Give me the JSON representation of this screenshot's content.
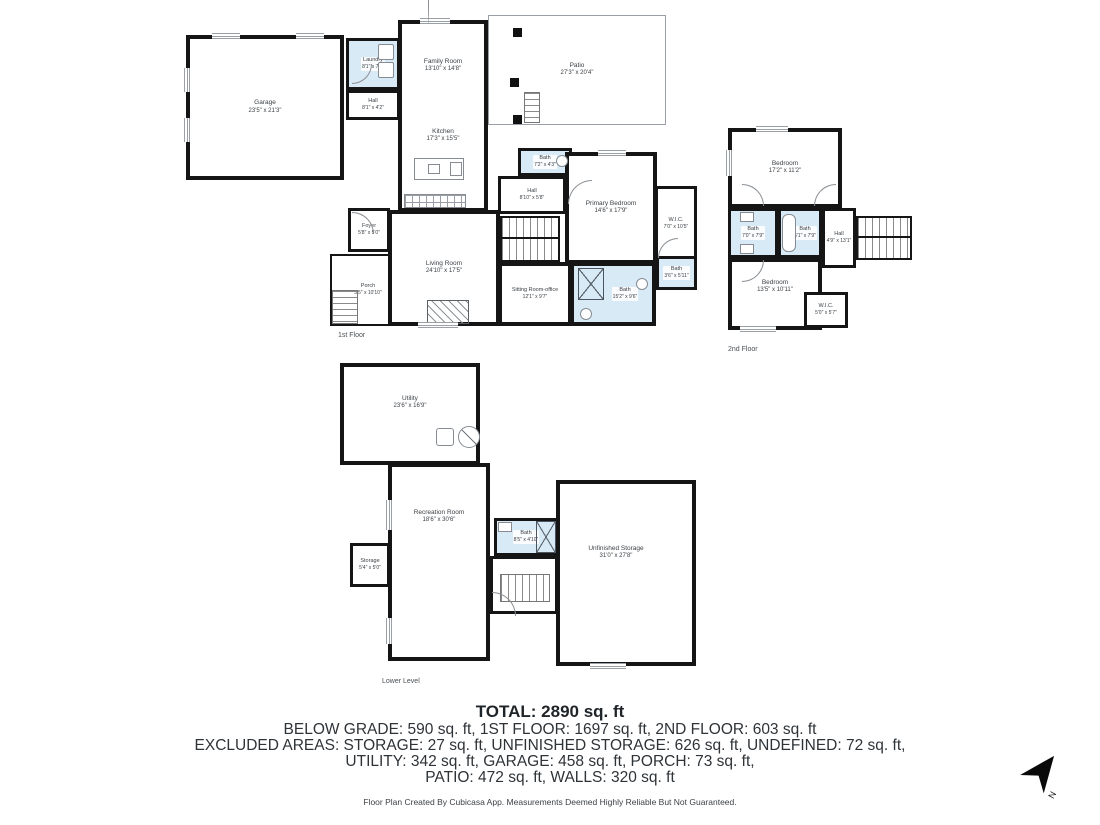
{
  "title": "Residential floor plan",
  "floors": {
    "first": {
      "label": "1st Floor",
      "rooms": {
        "garage": {
          "name": "Garage",
          "dims": "23'5\" x 21'3\""
        },
        "laundry": {
          "name": "Laundry",
          "dims": "8'1\" x 7'6\""
        },
        "hall_a": {
          "name": "Hall",
          "dims": "8'1\" x 4'2\""
        },
        "family": {
          "name": "Family Room",
          "dims": "13'10\" x 14'8\""
        },
        "kitchen": {
          "name": "Kitchen",
          "dims": "17'3\" x 15'5\""
        },
        "patio": {
          "name": "Patio",
          "dims": "27'3\" x 20'4\""
        },
        "bath_a": {
          "name": "Bath",
          "dims": "7'2\" x 4'3\""
        },
        "hall_b": {
          "name": "Hall",
          "dims": "8'10\" x 5'8\""
        },
        "primary_bedroom": {
          "name": "Primary Bedroom",
          "dims": "14'6\" x 17'9\""
        },
        "wic": {
          "name": "W.I.C.",
          "dims": "7'0\" x 10'5\""
        },
        "bath_b": {
          "name": "Bath",
          "dims": "3'6\" x 5'11\""
        },
        "bath_c": {
          "name": "Bath",
          "dims": "15'2\" x 9'6\""
        },
        "sitting": {
          "name": "Sitting Room-office",
          "dims": "12'1\" x 9'7\""
        },
        "living": {
          "name": "Living Room",
          "dims": "24'10\" x 17'5\""
        },
        "foyer": {
          "name": "Foyer",
          "dims": "5'8\" x 5'0\""
        },
        "porch": {
          "name": "Porch",
          "dims": "5'5\" x 10'10\""
        }
      }
    },
    "second": {
      "label": "2nd Floor",
      "rooms": {
        "bedroom_a": {
          "name": "Bedroom",
          "dims": "17'2\" x 11'2\""
        },
        "bath_a": {
          "name": "Bath",
          "dims": "7'0\" x 7'9\""
        },
        "bath_b": {
          "name": "Bath",
          "dims": "6'1\" x 7'9\""
        },
        "hall": {
          "name": "Hall",
          "dims": "4'9\" x 13'1\""
        },
        "bedroom_b": {
          "name": "Bedroom",
          "dims": "13'5\" x 10'11\""
        },
        "wic": {
          "name": "W.I.C.",
          "dims": "5'0\" x 5'7\""
        }
      }
    },
    "lower": {
      "label": "Lower Level",
      "rooms": {
        "utility": {
          "name": "Utility",
          "dims": "23'6\" x 16'9\""
        },
        "storage": {
          "name": "Storage",
          "dims": "5'4\" x 5'0\""
        },
        "recreation": {
          "name": "Recreation Room",
          "dims": "18'6\" x 30'6\""
        },
        "bath": {
          "name": "Bath",
          "dims": "8'5\" x 4'10\""
        },
        "unfinished": {
          "name": "Unfinished Storage",
          "dims": "31'0\" x 27'8\""
        }
      }
    }
  },
  "summary": {
    "total": "TOTAL: 2890 sq. ft",
    "line1": "BELOW GRADE: 590 sq. ft, 1ST FLOOR: 1697 sq. ft, 2ND FLOOR: 603 sq. ft",
    "line2": "EXCLUDED AREAS: STORAGE: 27 sq. ft, UNFINISHED STORAGE: 626 sq. ft, UNDEFINED: 72 sq. ft,",
    "line3": "UTILITY: 342 sq. ft, GARAGE: 458 sq. ft, PORCH: 73 sq. ft,",
    "line4": "PATIO: 472 sq. ft, WALLS: 320 sq. ft"
  },
  "footer": "Floor Plan Created By Cubicasa App. Measurements Deemed Highly Reliable But Not Guaranteed.",
  "compass": {
    "label": "N"
  },
  "icons": {
    "north-arrow": "black dart, CSS clip-path",
    "shower": "crossed box",
    "tub": "rounded rectangle",
    "sink": "small circle/square",
    "washer-dryer": "stacked squares",
    "stove": "grid rectangle",
    "water-heater": "circle with diagonal"
  },
  "colors": {
    "wall": "#151515",
    "wet_room_fill": "#d9eaf7",
    "text": "#3a3f44"
  }
}
